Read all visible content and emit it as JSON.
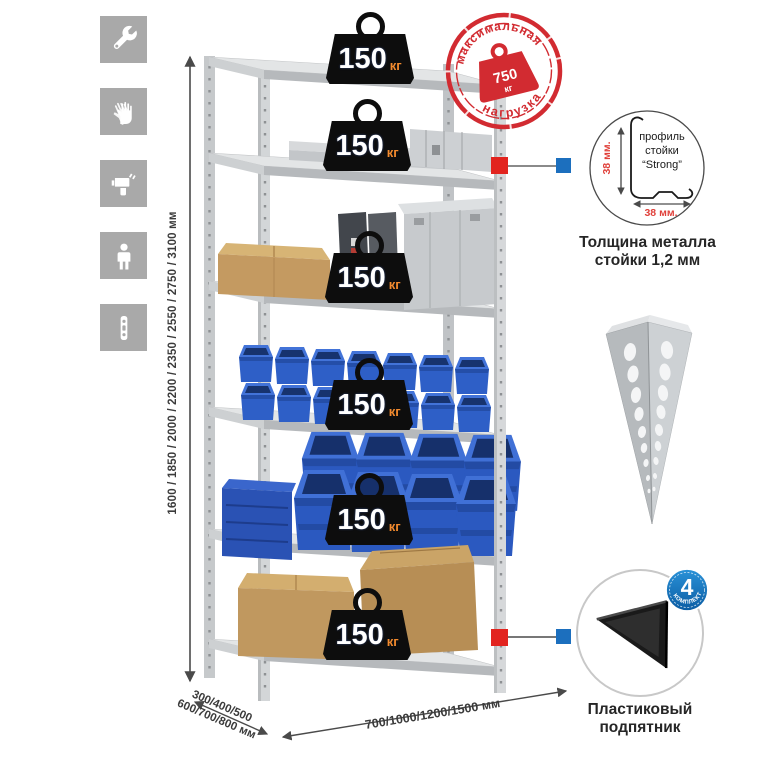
{
  "page": {
    "background": "#ffffff",
    "type": "product-infographic-shelving-rack"
  },
  "assembly_icons": {
    "items": [
      {
        "icon": "wrench-icon"
      },
      {
        "icon": "gloves-icon"
      },
      {
        "icon": "drill-icon"
      },
      {
        "icon": "person-icon"
      },
      {
        "icon": "post-strip-icon"
      }
    ]
  },
  "dims": {
    "height": "1600 / 1850 / 2000 / 2200 / 2350 / 2550 / 2750 / 3100 мм",
    "depth_line1": "300/400/500",
    "depth_line2": "600/700/800 мм",
    "width": "700/1000/1200/1500 мм"
  },
  "stamp": {
    "arc_top": "максимальная",
    "arc_bottom": "нагрузка",
    "value": "750",
    "unit": "кг"
  },
  "shelf_weights": [
    {
      "value": "150",
      "unit": "кг"
    },
    {
      "value": "150",
      "unit": "кг"
    },
    {
      "value": "150",
      "unit": "кг"
    },
    {
      "value": "150",
      "unit": "кг"
    },
    {
      "value": "150",
      "unit": "кг"
    },
    {
      "value": "150",
      "unit": "кг"
    }
  ],
  "profile_detail": {
    "label_line1": "профиль",
    "label_line2": "стойки",
    "label_line3": "“Strong”",
    "dim_vertical": "38 мм.",
    "dim_horizontal": "38 мм.",
    "caption_line1": "Толщина металла",
    "caption_line2": "стойки 1,2 мм"
  },
  "foot_detail": {
    "badge_value": "4",
    "badge_arc": "в комплекте",
    "caption_line1": "Пластиковый",
    "caption_line2": "подпятник"
  },
  "colors": {
    "stamp_red": "#d22b31",
    "callout_red": "#e2241f",
    "callout_blue": "#1c6fbe",
    "badge_blue": "#1878c1",
    "bin_blue": "#2b59c0",
    "weight_black": "#0d0d0d",
    "unit_orange": "#f28a2e",
    "icon_gray": "#a9a9a9",
    "metal_gray": "#d3d6d8",
    "cardboard_tan": "#c49a61",
    "dim_text_gray": "#3b3b3b",
    "red_dim_text": "#e0403a"
  }
}
